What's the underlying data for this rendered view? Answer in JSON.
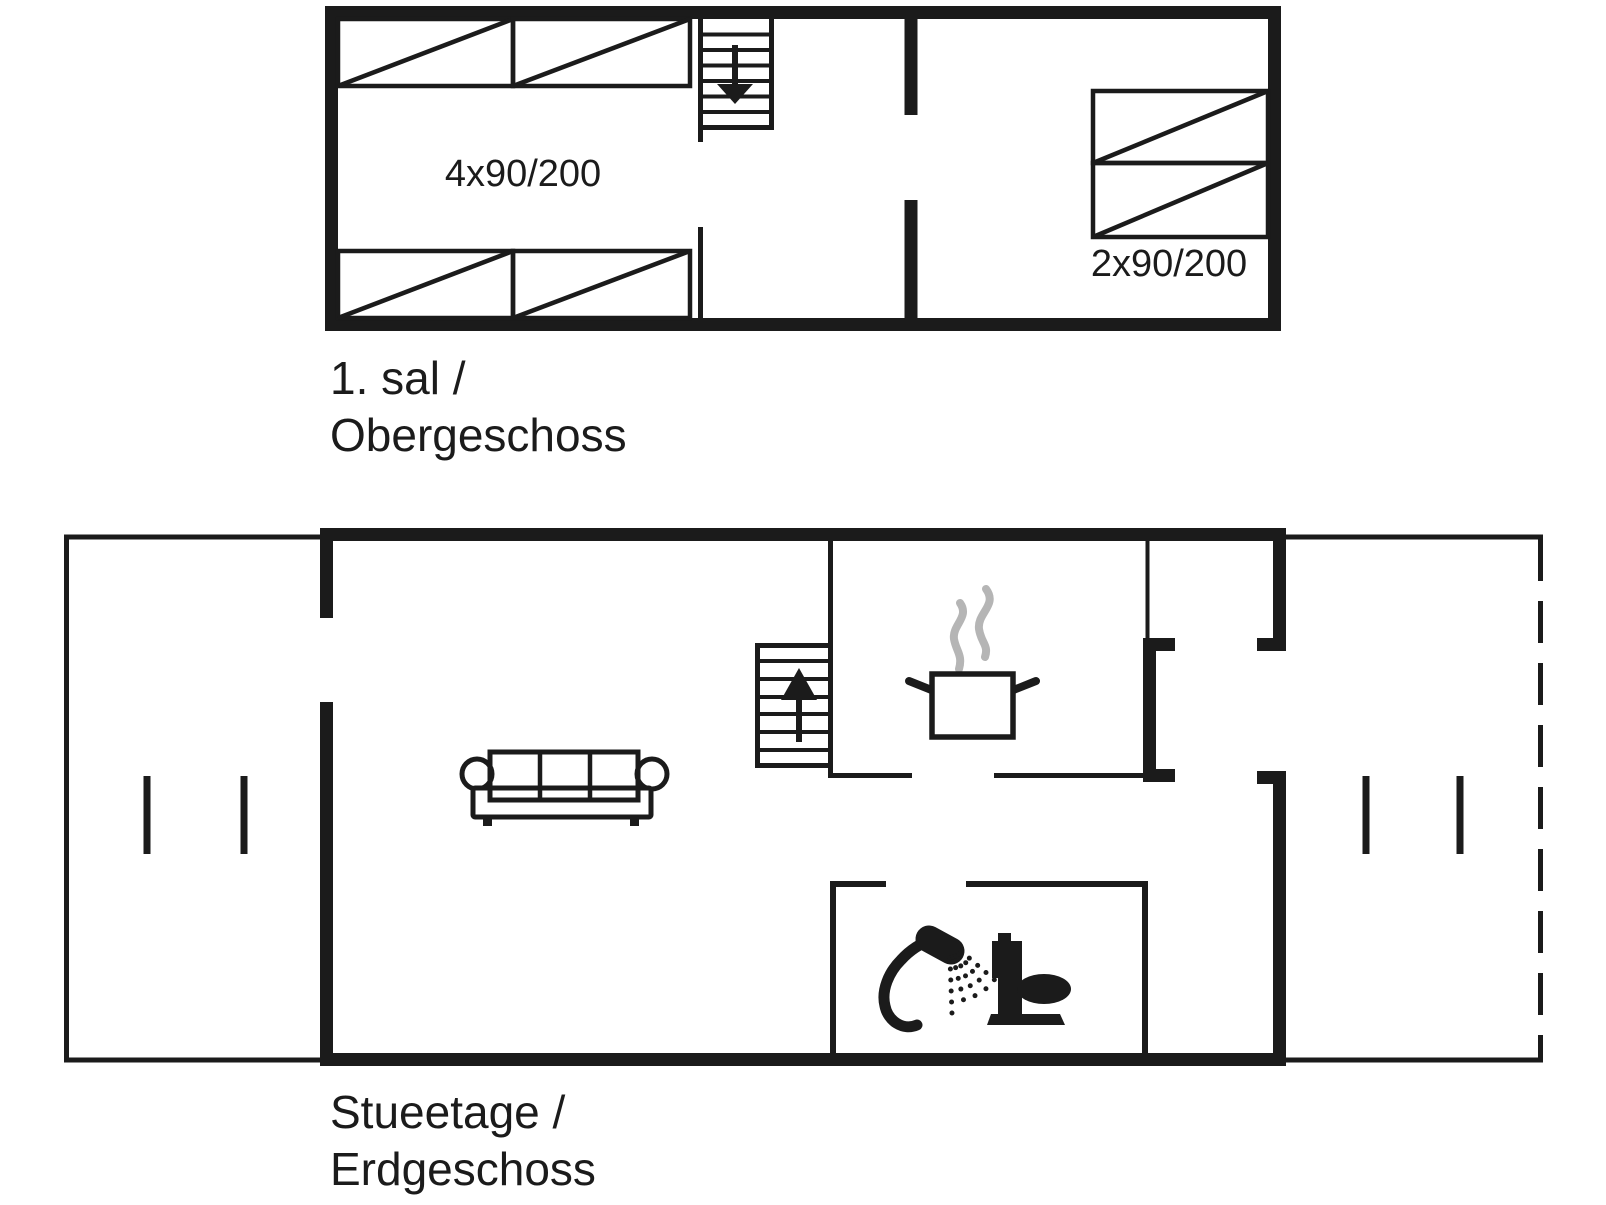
{
  "colors": {
    "ink": "#1b1b1b",
    "steam": "#b5b5b5",
    "background": "#ffffff"
  },
  "upper_floor": {
    "bed_left_dim": "4x90/200",
    "bed_right_dim": "2x90/200",
    "label_line1": "1. sal /",
    "label_line2": "Obergeschoss"
  },
  "ground_floor": {
    "label_line1": "Stueetage /",
    "label_line2": "Erdgeschoss"
  }
}
